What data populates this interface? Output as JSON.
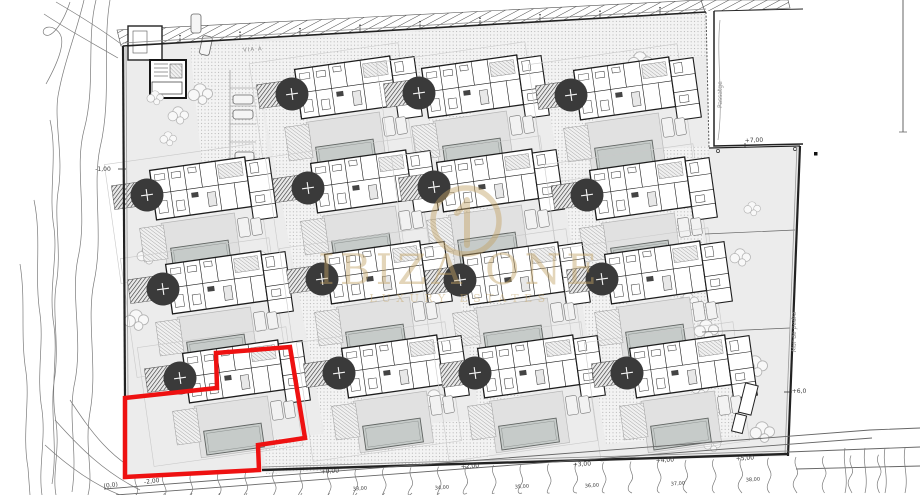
{
  "watermark": {
    "brand": "IBIZA ONE",
    "tagline": "LUXURY ESTATES",
    "color": "#c3a365"
  },
  "labels": {
    "road": "VIA A",
    "passage": "Passatge",
    "stone_wall": "Mur de pedra"
  },
  "elevation_markers": [
    {
      "text": "-1,00",
      "x": 103,
      "y": 171,
      "rot": 0
    },
    {
      "text": "+7,00",
      "x": 754,
      "y": 142,
      "rot": -2
    },
    {
      "text": "+6,0",
      "x": 799,
      "y": 393,
      "rot": 0
    },
    {
      "text": "+0,00",
      "x": 330,
      "y": 473,
      "rot": -4
    },
    {
      "text": "+2,00",
      "x": 470,
      "y": 468,
      "rot": -4
    },
    {
      "text": "+3,00",
      "x": 582,
      "y": 466,
      "rot": -4
    },
    {
      "text": "+4,00",
      "x": 665,
      "y": 462,
      "rot": -4
    },
    {
      "text": "+5,00",
      "x": 745,
      "y": 460,
      "rot": -4
    },
    {
      "text": "-2,00",
      "x": 152,
      "y": 483,
      "rot": -8
    },
    {
      "text": "(0,0)",
      "x": 111,
      "y": 487,
      "rot": -8
    }
  ],
  "contour_labels": [
    {
      "text": "33,00",
      "x": 360,
      "y": 490
    },
    {
      "text": "34,00",
      "x": 442,
      "y": 489
    },
    {
      "text": "35,00",
      "x": 522,
      "y": 488
    },
    {
      "text": "36,00",
      "x": 592,
      "y": 487
    },
    {
      "text": "37,00",
      "x": 678,
      "y": 485
    },
    {
      "text": "38,00",
      "x": 753,
      "y": 481
    }
  ],
  "highlight_plot": {
    "color": "#ee1111",
    "points": [
      [
        216,
        353
      ],
      [
        290,
        347
      ],
      [
        305,
        438
      ],
      [
        258,
        445
      ],
      [
        259,
        470
      ],
      [
        125,
        477
      ],
      [
        125,
        398
      ],
      [
        217,
        388
      ]
    ]
  },
  "site": {
    "villa_count": 15,
    "tree_positions": [
      [
        292,
        94
      ],
      [
        419,
        93
      ],
      [
        571,
        95
      ],
      [
        147,
        195
      ],
      [
        308,
        188
      ],
      [
        434,
        187
      ],
      [
        587,
        195
      ],
      [
        163,
        289
      ],
      [
        322,
        279
      ],
      [
        460,
        280
      ],
      [
        602,
        279
      ],
      [
        180,
        378
      ],
      [
        339,
        373
      ],
      [
        475,
        373
      ],
      [
        627,
        373
      ]
    ]
  }
}
